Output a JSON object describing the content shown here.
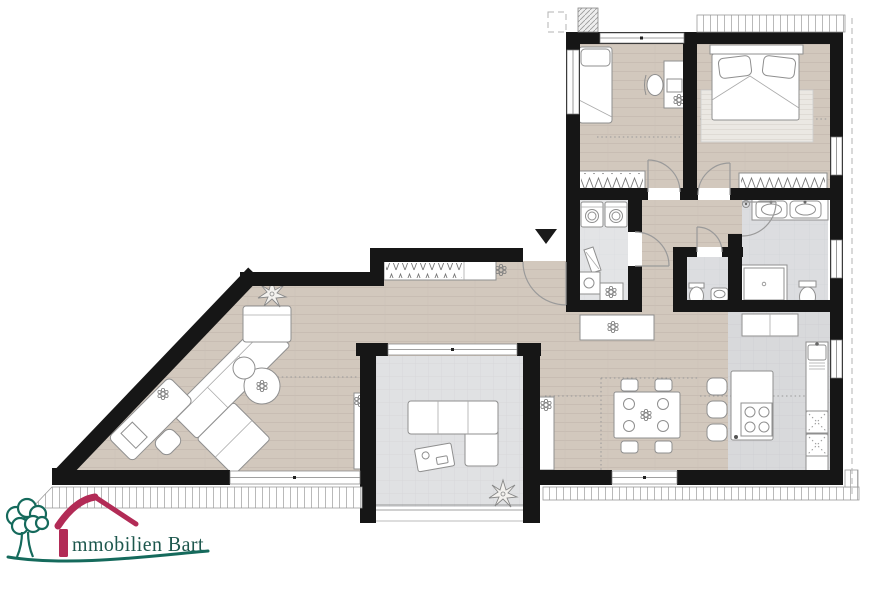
{
  "logo": {
    "aria": "Immobilien Bart",
    "wordmark": "mmobilien Bart",
    "icons": [
      "tree-icon",
      "roof-icon",
      "i-bar"
    ],
    "colors": {
      "tree_green": "#156a5c",
      "roof_red": "#b22b56",
      "text_teal": "#1d574d"
    }
  },
  "plan": {
    "type": "apartment-floor-plan",
    "entrance": {
      "marker": "arrow-down-icon"
    },
    "colors": {
      "wall": "#161616",
      "wood_floor": "#d2c8bd",
      "bath_tile": "#dcdde0",
      "terrace_tile": "#e0e1e3",
      "kitchen_tile": "#d8d9db",
      "utility_floor": "#e3e4e6",
      "furniture_stroke": "#8f8f8f",
      "rug": "#ebe8e3",
      "roof_guide_dotted": "#999999"
    },
    "rooms": [
      {
        "name": "living-room",
        "floor": "wood",
        "furniture": [
          "corner-sofa",
          "round-side-tables",
          "workstation-desk",
          "desk-chair",
          "corner-plant",
          "tv-sideboard"
        ]
      },
      {
        "name": "dining-area",
        "floor": "wood",
        "furniture": [
          "dining-table",
          "four-chairs",
          "four-plates",
          "centerpiece-flower",
          "sideboard"
        ]
      },
      {
        "name": "kitchen",
        "floor": "tile",
        "furniture": [
          "island-with-cooktop",
          "three-bar-stools",
          "sink-counter",
          "base-cabinets",
          "tall-cabinets"
        ]
      },
      {
        "name": "hallway",
        "floor": "wood",
        "furniture": [
          "coat-wardrobe",
          "doormat"
        ]
      },
      {
        "name": "utility-room",
        "floor": "tile",
        "furniture": [
          "washer",
          "dryer",
          "ironing-board",
          "utility-sink",
          "shelf"
        ]
      },
      {
        "name": "wc",
        "floor": "tile",
        "furniture": [
          "toilet",
          "hand-basin"
        ]
      },
      {
        "name": "bathroom",
        "floor": "tile",
        "furniture": [
          "double-vanity",
          "shower",
          "toilet",
          "ceiling-lamp"
        ]
      },
      {
        "name": "bedroom-1",
        "floor": "wood",
        "furniture": [
          "single-bed",
          "desk",
          "chair",
          "built-in-wardrobe"
        ]
      },
      {
        "name": "master-bedroom",
        "floor": "wood",
        "furniture": [
          "double-bed",
          "two-pillows",
          "rug",
          "built-in-wardrobe"
        ]
      },
      {
        "name": "terrace",
        "floor": "tile",
        "furniture": [
          "outdoor-corner-sofa",
          "coffee-table",
          "plant"
        ]
      }
    ]
  }
}
